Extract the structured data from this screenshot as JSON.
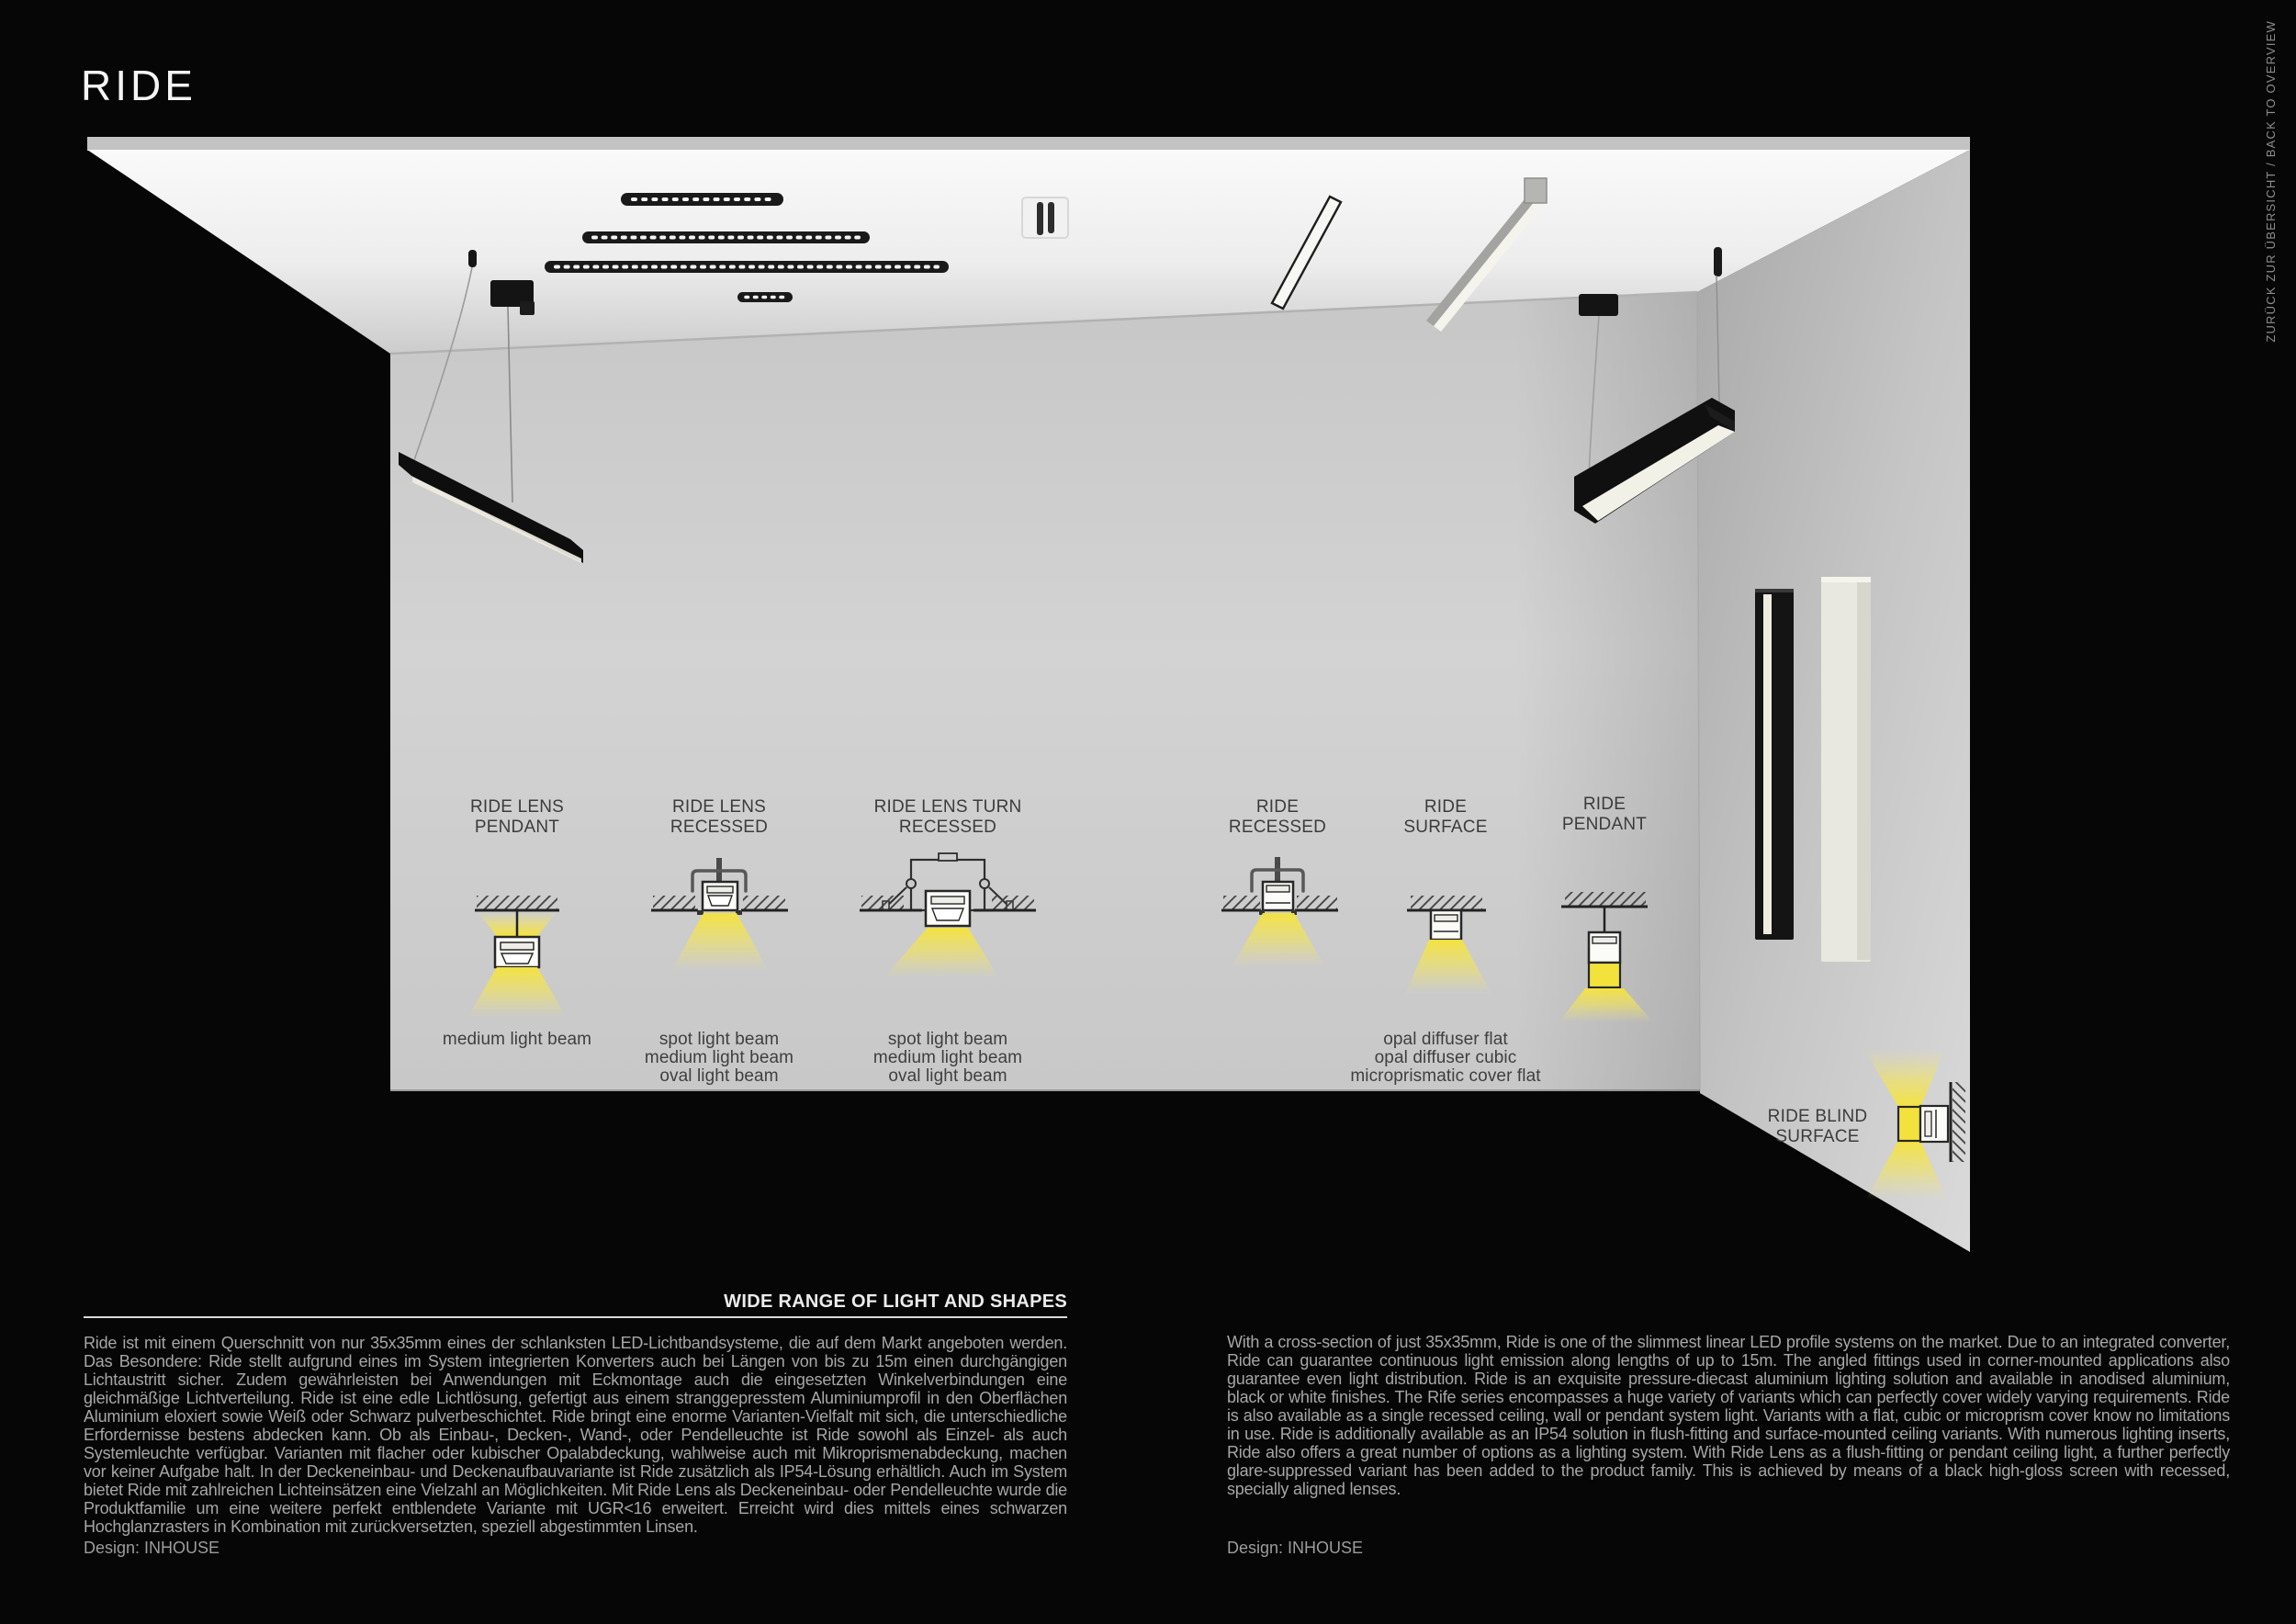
{
  "page": {
    "title": "RIDE",
    "back_link": "ZURÜCK ZUR ÜBERSICHT / BACK TO OVERVIEW"
  },
  "section": {
    "heading": "WIDE RANGE OF LIGHT AND SHAPES",
    "col_de": {
      "text": "Ride ist mit einem Querschnitt von nur 35x35mm eines der schlanksten LED-Lichtbandsysteme, die auf dem Markt angeboten werden. Das Besondere: Ride stellt aufgrund eines im System integrierten Konverters auch bei Längen von bis zu 15m einen durchgängigen Lichtaustritt sicher. Zudem gewährleisten bei Anwendungen mit Eckmontage auch die eingesetzten Winkelverbindungen eine gleichmäßige Lichtverteilung. Ride ist eine edle Lichtlösung, gefertigt aus einem stranggepresstem Aluminiumprofil in den Oberflächen Aluminium eloxiert sowie Weiß oder Schwarz pulverbeschichtet. Ride bringt eine enorme Varianten-Vielfalt mit sich, die unterschiedliche Erfordernisse bestens abdecken kann. Ob als Einbau-, Decken-, Wand-, oder Pendelleuchte ist Ride sowohl als Einzel- als auch Systemleuchte verfügbar. Varianten mit flacher oder kubischer Opalabdeckung, wahlweise auch mit Mikroprismenabdeckung, machen vor keiner Aufgabe halt. In der Deckeneinbau- und Deckenaufbauvariante ist Ride zusätzlich als IP54-Lösung erhältlich. Auch im System bietet Ride mit zahlreichen Lichteinsätzen eine Vielzahl an Möglichkeiten. Mit Ride Lens als Deckeneinbau- oder Pendelleuchte wurde die Produktfamilie um eine weitere perfekt entblendete Variante mit UGR<16 erweitert. Erreicht wird dies mittels eines schwarzen Hochglanzrasters in Kombination mit zurückversetzten, speziell abgestimmten Linsen.",
      "design": "Design: INHOUSE"
    },
    "col_en": {
      "text": "With a cross-section of just 35x35mm, Ride is one of the slimmest linear LED profile systems on the market. Due to an integrated converter, Ride can guarantee continuous light emission along lengths of up to 15m. The angled fittings used in corner-mounted applications also guarantee even light distribution. Ride is an exquisite pressure-diecast aluminium lighting solution and available in anodised aluminium, black or white finishes. The Rife series encompasses a huge variety of variants which can perfectly cover widely varying requirements. Ride is also available as a single recessed ceiling, wall or pendant system light. Variants with a flat, cubic or microprism cover know no limitations in use. Ride is additionally available as an IP54 solution in flush-fitting and surface-mounted ceiling variants. With numerous lighting inserts, Ride also offers a great number of options as a lighting system. With Ride Lens as a flush-fitting or pendant ceiling light, a further perfectly glare-suppressed variant has been added to the product family. This is achieved by means of a black high-gloss screen with recessed, specially aligned lenses.",
      "design": "Design: INHOUSE"
    }
  },
  "fixtures": [
    {
      "id": "ride-lens-pendant",
      "label_line1": "RIDE LENS",
      "label_line2": "PENDANT",
      "beams": [
        "medium light beam"
      ]
    },
    {
      "id": "ride-lens-recessed",
      "label_line1": "RIDE LENS",
      "label_line2": "RECESSED",
      "beams": [
        "spot light beam",
        "medium light beam",
        "oval light beam"
      ]
    },
    {
      "id": "ride-lens-turn-recessed",
      "label_line1": "RIDE LENS TURN",
      "label_line2": "RECESSED",
      "beams": [
        "spot light beam",
        "medium light beam",
        "oval light beam"
      ]
    },
    {
      "id": "ride-recessed",
      "label_line1": "RIDE",
      "label_line2": "RECESSED",
      "beams": []
    },
    {
      "id": "ride-surface",
      "label_line1": "RIDE",
      "label_line2": "SURFACE",
      "beams": [
        "opal diffuser flat",
        "opal diffuser cubic",
        "microprismatic cover flat"
      ]
    },
    {
      "id": "ride-pendant",
      "label_line1": "RIDE",
      "label_line2": "PENDANT",
      "beams": []
    },
    {
      "id": "ride-blind-surface",
      "label_line1": "RIDE BLIND",
      "label_line2": "SURFACE",
      "beams": []
    }
  ],
  "colors": {
    "beam_yellow": "#f5e43c",
    "page_background": "#060606",
    "wall_gray": "#cdcdcd",
    "text_muted": "#a6a6a6"
  }
}
